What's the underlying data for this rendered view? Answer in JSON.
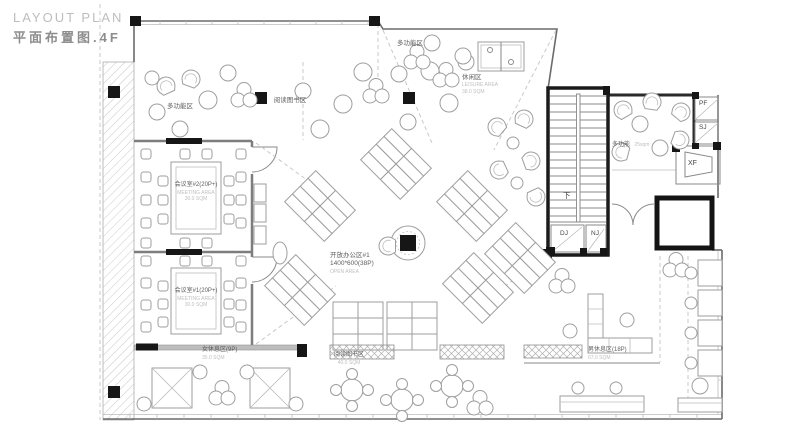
{
  "title": {
    "en": "LAYOUT PLAN",
    "zh": "平面布置图.4F"
  },
  "rooms": {
    "multi_top_left": {
      "name": "多功能区"
    },
    "reading_top": {
      "name": "阅读图书区"
    },
    "multi_top": {
      "name": "多功能区"
    },
    "leisure": {
      "name": "休闲区",
      "sub": "LEISURE AREA",
      "area": "38.0 SQM"
    },
    "lounge_right": {
      "name": "多功能",
      "area": "25sqm"
    },
    "meeting2": {
      "name": "会议室#2(20P+)",
      "sub": "MEETING AREA",
      "area": "30.0 SQM"
    },
    "meeting1": {
      "name": "会议室#1(20P+)",
      "sub": "MEETING AREA",
      "area": "30.0 SQM"
    },
    "open_office": {
      "name": "开放办公区#1",
      "spec": "1400*600(38P)",
      "sub": "OPEN AREA"
    },
    "women_rest": {
      "name": "女休息区(9P)",
      "area": "35.0 SQM"
    },
    "men_rest": {
      "name": "男休息区(18P)",
      "area": "67.0 SQM"
    },
    "reading_bottom": {
      "name": "阅读图书区",
      "area": "40.0 SQM"
    }
  },
  "shafts": {
    "pf": "PF",
    "sj": "SJ",
    "xf": "XF",
    "dj": "DJ",
    "nj": "NJ",
    "stair_down": "下"
  }
}
